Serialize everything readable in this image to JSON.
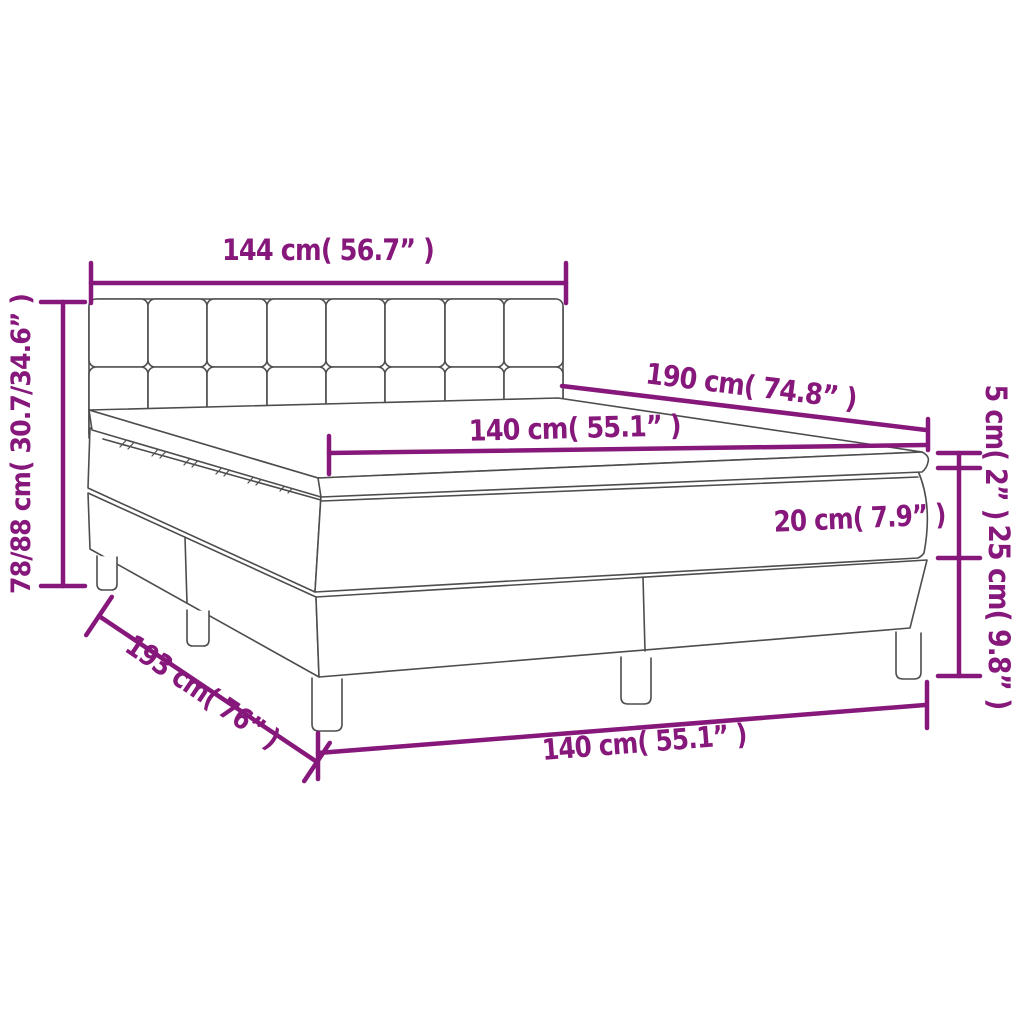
{
  "diagram": {
    "title": "box-spring-bed-dimension-diagram",
    "colors": {
      "dimension_accent": "#87187B",
      "outline_gray": "#4D4D4D",
      "background": "#FFFFFF"
    },
    "dimensions": {
      "headboard_width": "144 cm( 56.7” )",
      "bed_length": "190 cm( 74.8” )",
      "mattress_width_top": "140 cm( 55.1” )",
      "mattress_thickness": "20 cm( 7.9” )",
      "topper_thickness": "5 cm( 2” )",
      "base_height": "25 cm( 9.8” )",
      "total_height_range": "78/88 cm( 30.7/34.6” )",
      "base_length": "193 cm( 76” )",
      "base_width_bottom": "140 cm( 55.1” )"
    }
  }
}
